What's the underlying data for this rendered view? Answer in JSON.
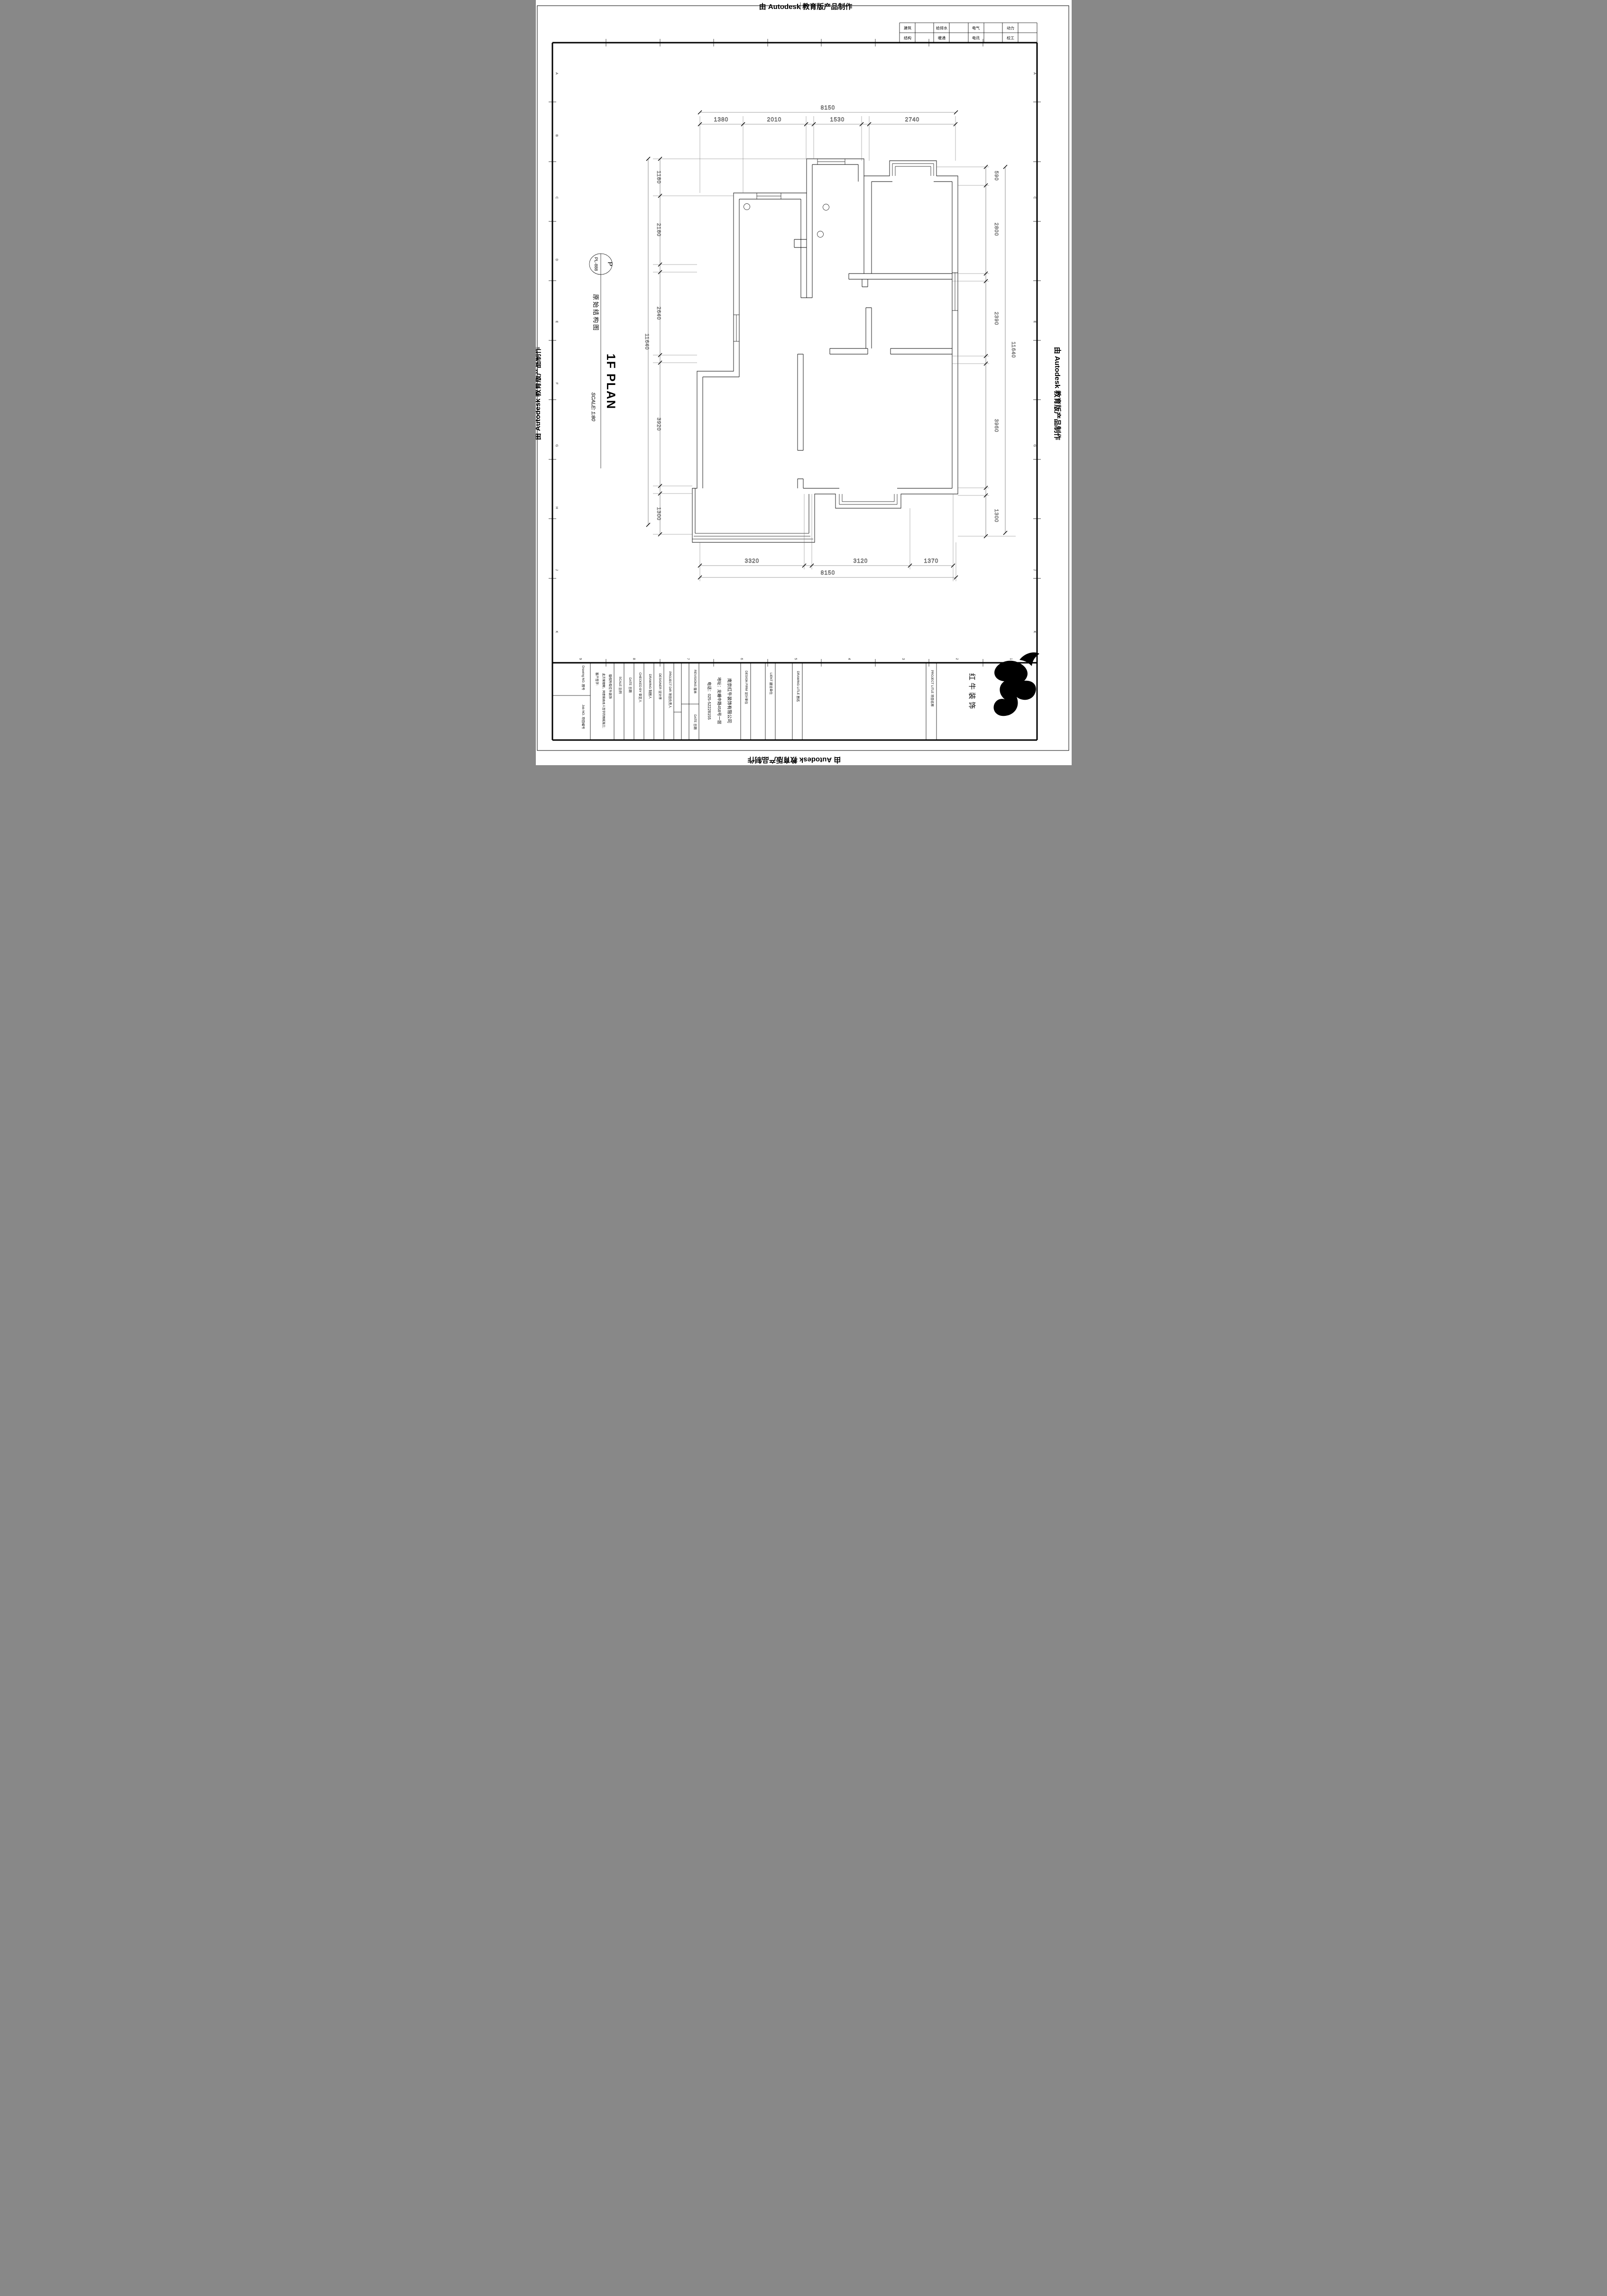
{
  "edges": {
    "top": "由 Autodesk 教育版产品制作",
    "bottom": "由 Autodesk 教育版产品制作",
    "left": "由 Autodesk 教育版产品制作",
    "right": "由 Autodesk 教育版产品制作"
  },
  "discipline_table": {
    "rows": [
      {
        "cells": [
          "建筑",
          "给排水",
          "电气",
          "动力"
        ]
      },
      {
        "cells": [
          "结构",
          "暖通",
          "电讯",
          "校工"
        ]
      }
    ]
  },
  "sheet_label": {
    "detail_letter": "P",
    "sheet_no": "PL-888",
    "title_cn": "原始结构图",
    "title_en": "1F PLAN",
    "scale": "SCALE: 1:80"
  },
  "grid": {
    "rows": [
      "A",
      "B",
      "C",
      "D",
      "E",
      "F",
      "G",
      "H",
      "J",
      "K"
    ],
    "cols": [
      "9",
      "8",
      "7",
      "6",
      "5",
      "4",
      "3",
      "2",
      "1"
    ]
  },
  "dimensions": {
    "top": {
      "overall": "8150",
      "segments": [
        "1380",
        "2010",
        "1530",
        "2740"
      ]
    },
    "bottom": {
      "overall": "8150",
      "segments": [
        "3320",
        "3120",
        "1370"
      ]
    },
    "left": {
      "overall": "11640",
      "segments": [
        "1180",
        "2180",
        "2640",
        "3920",
        "1300"
      ]
    },
    "right": {
      "overall": "11640",
      "segments": [
        "590",
        "2800",
        "2390",
        "3960",
        "1300"
      ]
    }
  },
  "title_block": {
    "drawing_no_label": "Drawing NO. 图号",
    "job_no_label": "Job NO. 项目编号",
    "copyright_line1": "版权所有红牛装饰",
    "copyright_line2": "此方案理解，同意按由本人签字的图纸施工;",
    "copyright_line3": "客户签字:",
    "scale_label": "SCALE 比例",
    "date_label": "DATE 日期",
    "checked_by_label": "CHECKED BY 审定人",
    "drawing_by_label": "DRAWING 制图人",
    "designer_label": "DESIGNER 设计师",
    "project_dir_label": "PROJECT DIR 项目负责人",
    "revisions_label": "REVISIONS 版本",
    "revision_date_label": "DATE 日期",
    "design_firm_label": "DESIGN FIRM 设计单位",
    "client_label": "LIENT 建设单位",
    "drawing_title_label": "DRAWING LITLE 图名",
    "project_title_label": "PROJECT LITLE 项目名称",
    "company": {
      "name": "南京红牛装饰有限公司",
      "address": "地址：龙蟠中路458号一层",
      "phone": "电话：025-52228155"
    },
    "logo_text": "红牛装饰"
  }
}
